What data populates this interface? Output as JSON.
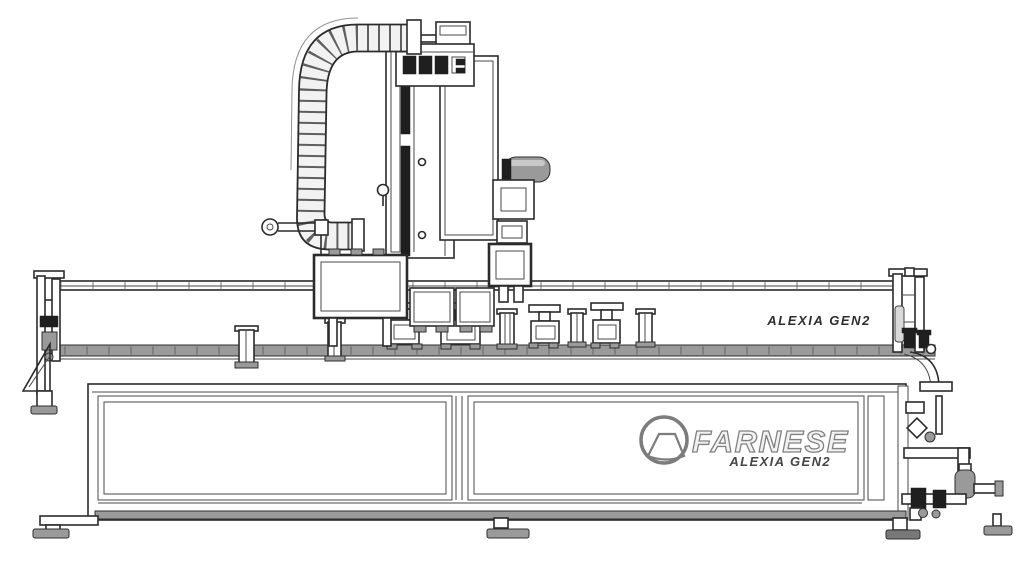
{
  "canvas": {
    "width": 1024,
    "height": 576,
    "background": "#ffffff"
  },
  "palette": {
    "line": "#2b2b2b",
    "mid_gray": "#9a9a9a",
    "dark_fill": "#1f1f1f",
    "light_gray": "#d9d9d9",
    "logo_gray": "#7c7c7c",
    "label_text": "#2e2e2e"
  },
  "illustration": {
    "subject": "FARNESE ALEXIA GEN2",
    "labels": {
      "bed_model": "ALEXIA GEN2",
      "logo_brand": "FARNESE",
      "logo_model": "ALEXIA GEN2"
    },
    "parts": [
      "cable-carrier-chain",
      "top-valve-manifold",
      "machine-column",
      "z-slide-plate",
      "spindle-motor",
      "spindle-head",
      "x-carriage",
      "coolant-elbow",
      "work-clamps",
      "bed-assembly",
      "left-end-frame",
      "right-end-frame",
      "pneumatic-unit",
      "base-cabinet",
      "leveling-feet",
      "brand-logo"
    ]
  }
}
